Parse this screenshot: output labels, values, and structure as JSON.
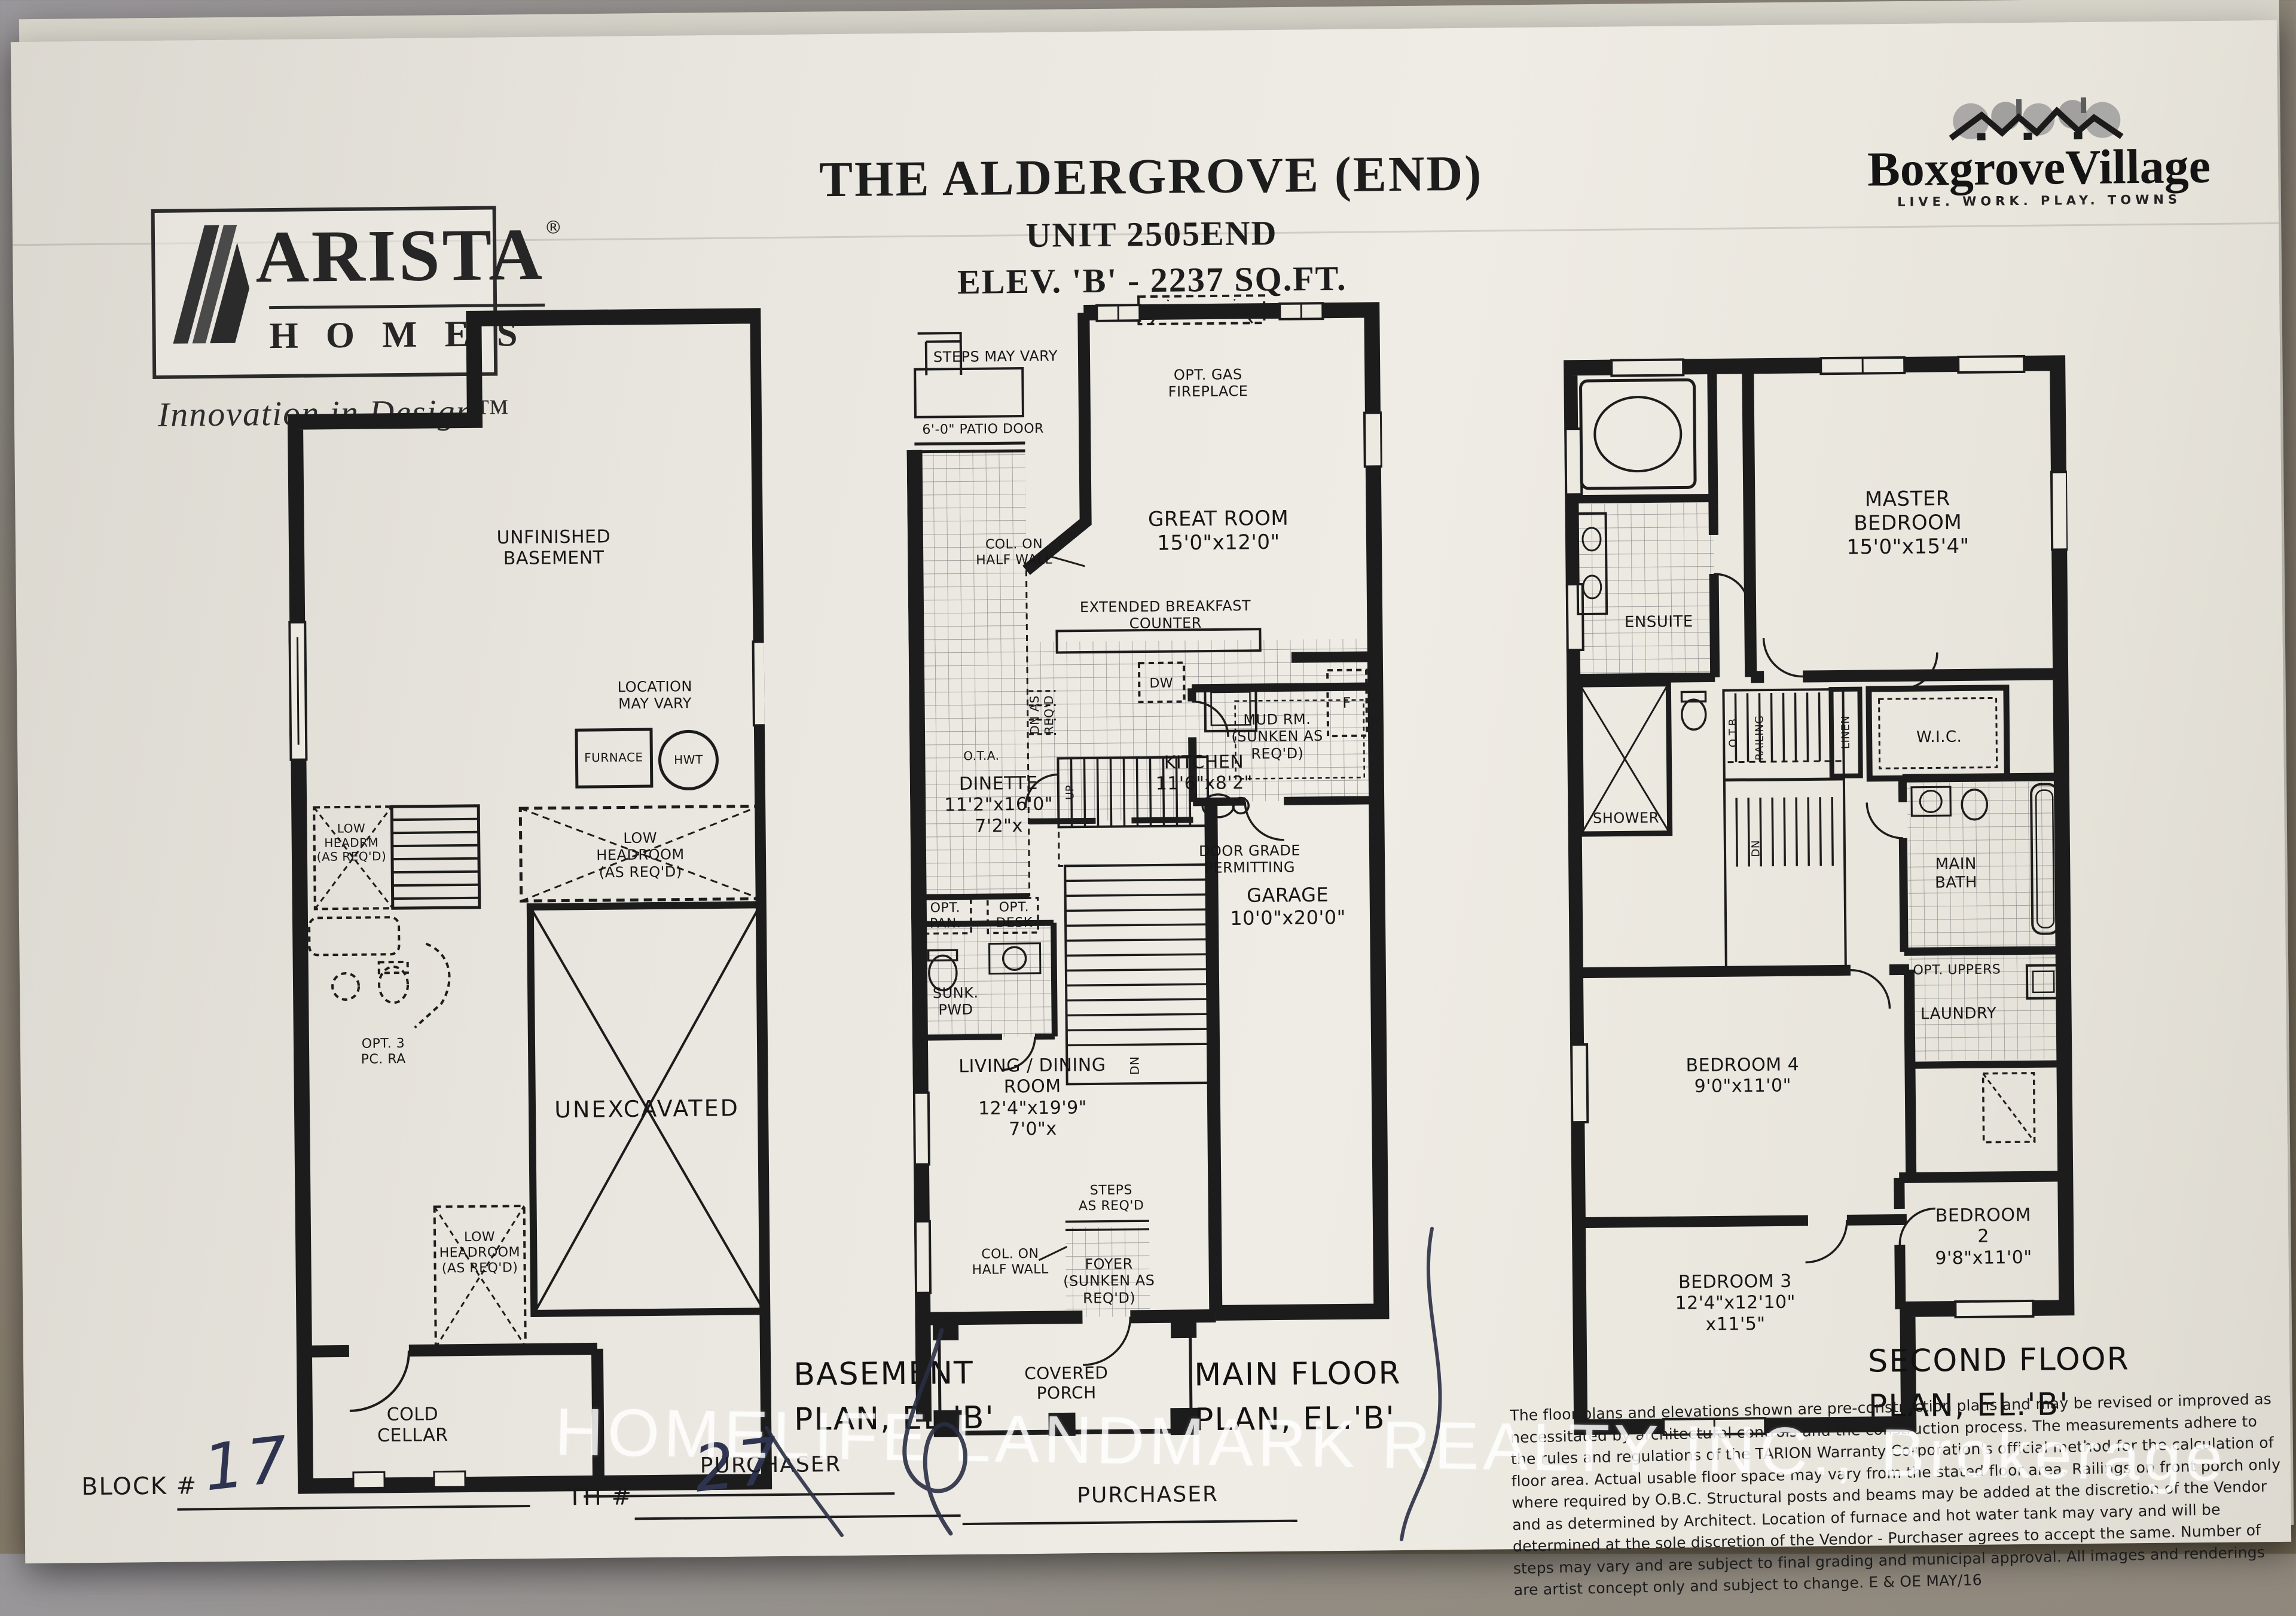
{
  "header": {
    "arista_name": "ARISTA",
    "arista_reg": "®",
    "arista_homes": "HOMES",
    "arista_tagline": "Innovation in Design™",
    "title_line1": "THE ALDERGROVE (END)",
    "title_line2": "UNIT 2505END",
    "title_line3": "ELEV. 'B' - 2237 SQ.FT.",
    "boxgrove_name": "BoxgroveVillage",
    "boxgrove_tagline": "LIVE. WORK. PLAY. TOWNS"
  },
  "basement": {
    "unfinished": "UNFINISHED\nBASEMENT",
    "location": "LOCATION\nMAY VARY",
    "furnace": "FURNACE",
    "hwt": "HWT",
    "low_headroom_right": "LOW\nHEADROOM\n(AS REQ'D)",
    "low_headrm_left": "LOW\nHEADRM\n(AS REQ'D)",
    "opt_3pc": "OPT. 3\nPC. RA",
    "unexcavated": "UNEXCAVATED",
    "low_headroom_cold": "LOW\nHEADROOM\n(AS REQ'D)",
    "cold_cellar": "COLD\nCELLAR",
    "caption": "BASEMENT\nPLAN, EL.'B'"
  },
  "main": {
    "steps_may_vary": "STEPS MAY VARY",
    "patio_door": "6'-0\" PATIO DOOR",
    "opt_gas_fireplace": "OPT. GAS\nFIREPLACE",
    "great_room": "GREAT ROOM\n15'0\"x12'0\"",
    "col_half_wall_top": "COL. ON\nHALF WALL",
    "ext_breakfast": "EXTENDED BREAKFAST\nCOUNTER",
    "dw": "DW",
    "fridge": "F",
    "dinette": "DINETTE\n11'2\"x16'0\"\n7'2\"x",
    "kitchen": "KITCHEN\n11'6\"x8'2\"",
    "opt_pan": "OPT.\nPAN.",
    "opt_desk": "OPT.\nDESK",
    "mud_rm": "MUD RM.\n(SUNKEN AS REQ'D)",
    "dn_as_reqd": "DN AS\nREQ'D",
    "ota": "O.T.A.",
    "up": "UP",
    "dn": "DN",
    "door_grade": "DOOR GRADE\nPERMITTING",
    "sunk_pwd": "SUNK.\nPWD",
    "garage": "GARAGE\n10'0\"x20'0\"",
    "living": "LIVING / DINING\nROOM\n12'4\"x19'9\"\n7'0\"x",
    "steps_as_reqd": "STEPS\nAS REQ'D",
    "col_half_wall_bottom": "COL. ON\nHALF WALL",
    "foyer": "FOYER\n(SUNKEN AS\nREQ'D)",
    "covered_porch": "COVERED\nPORCH",
    "caption": "MAIN FLOOR\nPLAN, EL.'B'"
  },
  "second": {
    "master": "MASTER BEDROOM\n15'0\"x15'4\"",
    "ensuite": "ENSUITE",
    "shower": "SHOWER",
    "linen": "LINEN",
    "wic": "W.I.C.",
    "otb": "O.T.B.",
    "railing": "RAILING",
    "dn": "DN",
    "main_bath": "MAIN\nBATH",
    "opt_uppers": "OPT. UPPERS",
    "laundry": "LAUNDRY",
    "bedroom4": "BEDROOM 4\n9'0\"x11'0\"",
    "bedroom2": "BEDROOM 2\n9'8\"x11'0\"",
    "bedroom3": "BEDROOM 3\n12'4\"x12'10\"\nx11'5\"",
    "caption": "SECOND FLOOR\nPLAN, EL.'B'"
  },
  "footer": {
    "block_label": "BLOCK #",
    "block_value": "17",
    "th_label": "TH #",
    "th_value": "27",
    "purchaser1": "PURCHASER",
    "purchaser2": "PURCHASER",
    "disclaimer": "The floor plans and elevations shown are pre-construction plans and may be revised or improved as necessitated by architectural controls and the construction process. The measurements adhere to the rules and regulations of the TARION Warranty Corporation's official method for the calculation of floor area. Actual usable floor space may vary from the stated floor area. Railings on front porch only where required by O.B.C. Structural posts and beams may be added at the discretion of the Vendor and as determined by Architect. Location of furnace and hot water tank may vary and will be determined at the sole discretion of the Vendor - Purchaser agrees to accept the same. Number of steps may vary and are subject to final grading and municipal approval. All images and renderings are artist concept only and subject to change. E & OE MAY/16",
    "watermark": "HOMELIFE LANDMARK REALTY INC., Brokerage"
  }
}
